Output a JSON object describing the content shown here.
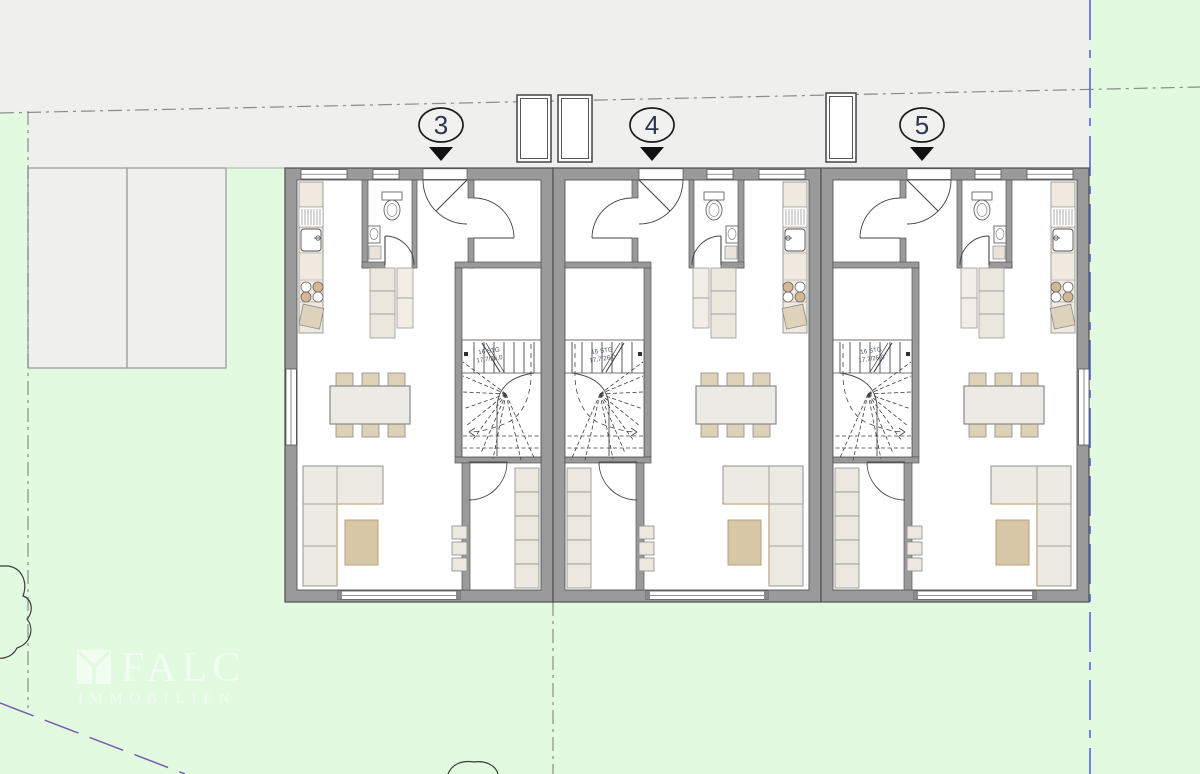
{
  "plan": {
    "type": "architectural-floor-plan-ground-floor-3-townhouses",
    "unit_markers": [
      {
        "label": "3"
      },
      {
        "label": "4"
      },
      {
        "label": "5"
      }
    ],
    "stair_annotation": {
      "line1": "16 STG",
      "line2": "17,7/26,0"
    },
    "watermark": {
      "brand": "FALC",
      "subtitle": "IMMOBILIEN"
    },
    "colors": {
      "lawn": "#e2fae0",
      "pavement": "#efefee",
      "parking": "#f0f0ef",
      "wall": "#9a9a9a",
      "wall_edge": "#4f4f4f",
      "boundary_gray": "#8b8b8b",
      "boundary_blue": "#5b6cf0",
      "boundary_purple": "#7a5ab2",
      "furniture_cream": "#ece8dd",
      "furniture_tan": "#d8c7a7",
      "marker_ink": "#2c3550"
    }
  }
}
